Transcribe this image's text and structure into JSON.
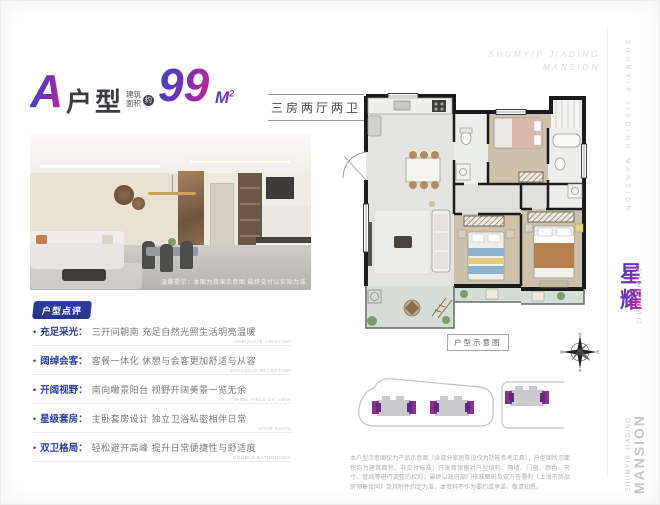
{
  "header": {
    "unit_letter": "A",
    "unit_label": "户型",
    "area_prefix_line1": "建筑",
    "area_prefix_line2": "面积",
    "area_approx": "约",
    "area_value": "99",
    "area_unit": "M",
    "area_unit_sup": "2",
    "layout_text": "三房两厅两卫"
  },
  "brand": {
    "top_right_line1": "SHUMYIP JIADING",
    "top_right_line2": "MANSION",
    "side_vertical_text": "SHUMYIP JIADING MANSION",
    "logo_cn": "星耀",
    "logo_pinyin": "XING YAO",
    "side_bottom_line1": "SHUMYIP JIADING",
    "side_bottom_line2": "MANSION"
  },
  "photo": {
    "caption": "温馨提示：本图为效果示意图 最终交付以实际为准"
  },
  "review": {
    "badge": "户型点评",
    "items": [
      {
        "title": "充足采光：",
        "text": "三开间朝南 充足自然光照生活明亮温暖",
        "en": "ADEQUATE LIGHTING"
      },
      {
        "title": "阔绰会客：",
        "text": "客餐一体化 休憩与会客更加舒适与从容",
        "en": "SPACIOUS RECEPTION"
      },
      {
        "title": "开阔视野：",
        "text": "南向瞰景阳台 视野开阔美景一览无余",
        "en": "WIDE FIELD OF VIEW"
      },
      {
        "title": "星级套房：",
        "text": "主卧套房设计 独立卫浴私密相伴日常",
        "en": "STAR SUITE"
      },
      {
        "title": "双卫格局：",
        "text": "轻松避开高峰 提升日常便捷性与舒适度",
        "en": "DOUBLE BATHROOMS"
      }
    ]
  },
  "floorplan": {
    "label": "户型示意图",
    "compass": {
      "n": "N",
      "e": "E",
      "s": "S",
      "w": "W"
    }
  },
  "disclaimer": "本户型示意图仅为产品示意图（含部分家居陈设仅为功能参考工具），户型图所示面积均为建筑面积，非交付标准；开发商保留对户型结构、隔墙、门窗、颜色、尺寸、管线等进行调整的权利；最终以政府部门核准图纸及双方签署的《上海市商品房预售合同》及其附件约定为准，本资料不作为要约或承诺，敬请知悉。",
  "colors": {
    "accent_gradient_start": "#3a47c4",
    "accent_gradient_end": "#c2268e",
    "title_blue": "#2c3c9e",
    "badge_bg": "#2b3894",
    "building_purple": "#7c2f8e"
  }
}
